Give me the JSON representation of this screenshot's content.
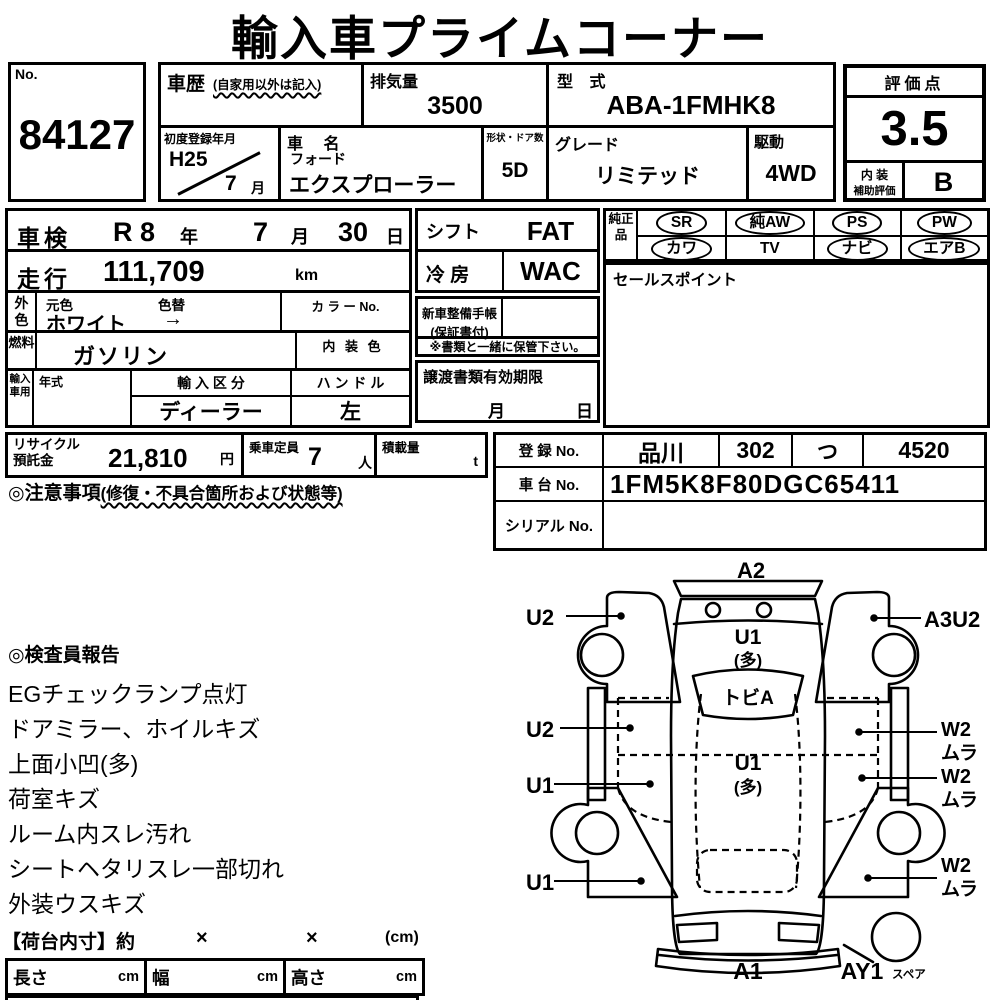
{
  "title": "輸入車プライムコーナー",
  "colors": {
    "ink": "#000000",
    "paper": "#ffffff"
  },
  "no_box": {
    "label": "No.",
    "value": "84127"
  },
  "history": {
    "label": "車歴",
    "note": "(自家用以外は記入)"
  },
  "displacement": {
    "label": "排気量",
    "value": "3500"
  },
  "model_code": {
    "label": "型 式",
    "value": "ABA-1FMHK8"
  },
  "first_registration": {
    "label": "初度登録年月",
    "year": "H25",
    "month": "7",
    "month_unit": "月"
  },
  "car_name": {
    "label": "車 名",
    "maker": "フォード",
    "model": "エクスプローラー"
  },
  "body_doors": {
    "label": "形状・ドア数",
    "value": "5D"
  },
  "grade": {
    "label": "グレード",
    "value": "リミテッド"
  },
  "drive": {
    "label": "駆動",
    "value": "4WD"
  },
  "rating": {
    "label": "評価点",
    "score": "3.5",
    "interior_label_top": "内 装",
    "interior_label_bottom": "補助評価",
    "interior_grade": "B"
  },
  "shaken": {
    "label": "車検",
    "era_year": "R 8",
    "year_unit": "年",
    "month": "7",
    "month_unit": "月",
    "day": "30",
    "day_unit": "日"
  },
  "mileage": {
    "label": "走行",
    "value": "111,709",
    "unit": "km"
  },
  "exterior_color": {
    "side_label": "外色",
    "original_label": "元色",
    "change_label": "色替",
    "value": "ホワイト",
    "arrow": "→",
    "color_no_label": "カ ラ ー No."
  },
  "fuel": {
    "side_label": "燃料",
    "value": "ガソリン",
    "interior_color_label": "内 装 色"
  },
  "import_info": {
    "side_label": "輸入車用",
    "year_label": "年式",
    "division_label": "輸 入 区 分",
    "division_value": "ディーラー",
    "steering_label": "ハ ン ド ル",
    "steering_value": "左"
  },
  "shift": {
    "label": "シフト",
    "value": "FAT"
  },
  "aircon": {
    "label": "冷 房",
    "value": "WAC"
  },
  "service_book": {
    "line1": "新車整備手帳",
    "line2": "(保証書付)"
  },
  "storage_note": "※書類と一緒に保管下さい。",
  "transfer_docs": {
    "label": "譲渡書類有効期限",
    "month_unit": "月",
    "day_unit": "日"
  },
  "genuine_parts": {
    "label": "純正品",
    "items": [
      {
        "text": "SR",
        "shape": "oval"
      },
      {
        "text": "純AW",
        "shape": "oval"
      },
      {
        "text": "PS",
        "shape": "oval"
      },
      {
        "text": "PW",
        "shape": "oval"
      },
      {
        "text": "カワ",
        "shape": "oval"
      },
      {
        "text": "TV",
        "shape": "plain"
      },
      {
        "text": "ナビ",
        "shape": "oval"
      },
      {
        "text": "エアB",
        "shape": "oval"
      }
    ]
  },
  "sales_point": {
    "label": "セールスポイント"
  },
  "recycle_deposit": {
    "label_line1": "リサイクル",
    "label_line2": "預託金",
    "value": "21,810",
    "unit": "円"
  },
  "seating": {
    "label": "乗車定員",
    "value": "7",
    "unit": "人"
  },
  "load_capacity": {
    "label": "積載量",
    "unit": "t"
  },
  "caution": {
    "heading": "◎注意事項",
    "detail": "(修復・不具合箇所および状態等)"
  },
  "registration": {
    "reg_label": "登 録 No.",
    "reg_area": "品川",
    "reg_class": "302",
    "reg_kana": "つ",
    "reg_number": "4520",
    "chassis_label": "車 台 No.",
    "chassis_value": "1FM5K8F80DGC65411",
    "serial_label": "シリアル No."
  },
  "inspector_report": {
    "title": "◎検査員報告",
    "lines": [
      "EGチェックランプ点灯",
      "ドアミラー、ホイルキズ",
      "上面小凹(多)",
      "荷室キズ",
      "ルーム内スレ汚れ",
      "シートヘタリスレ一部切れ",
      "外装ウスキズ"
    ]
  },
  "cargo_dimensions": {
    "title": "【荷台内寸】約",
    "times1": "×",
    "times2": "×",
    "unit": "(cm)",
    "fields": [
      {
        "label": "長さ",
        "unit": "cm"
      },
      {
        "label": "幅",
        "unit": "cm"
      },
      {
        "label": "高さ",
        "unit": "cm"
      }
    ]
  },
  "damage_diagram": {
    "a2": "A2",
    "u2_top": "U2",
    "a3u2": "A3U2",
    "tailgate_u1": "U1",
    "tailgate_u1_sub": "(多)",
    "rear_glass": "トビA",
    "u2_mid": "U2",
    "w2_1": "W2",
    "mura_1": "ムラ",
    "u1_mid": "U1",
    "roof_u1": "U1",
    "roof_u1_sub": "(多)",
    "w2_2": "W2",
    "mura_2": "ムラ",
    "u1_bottom": "U1",
    "w2_3": "W2",
    "mura_3": "ムラ",
    "a1": "A1",
    "ay1": "AY1",
    "spare": "スペア"
  }
}
